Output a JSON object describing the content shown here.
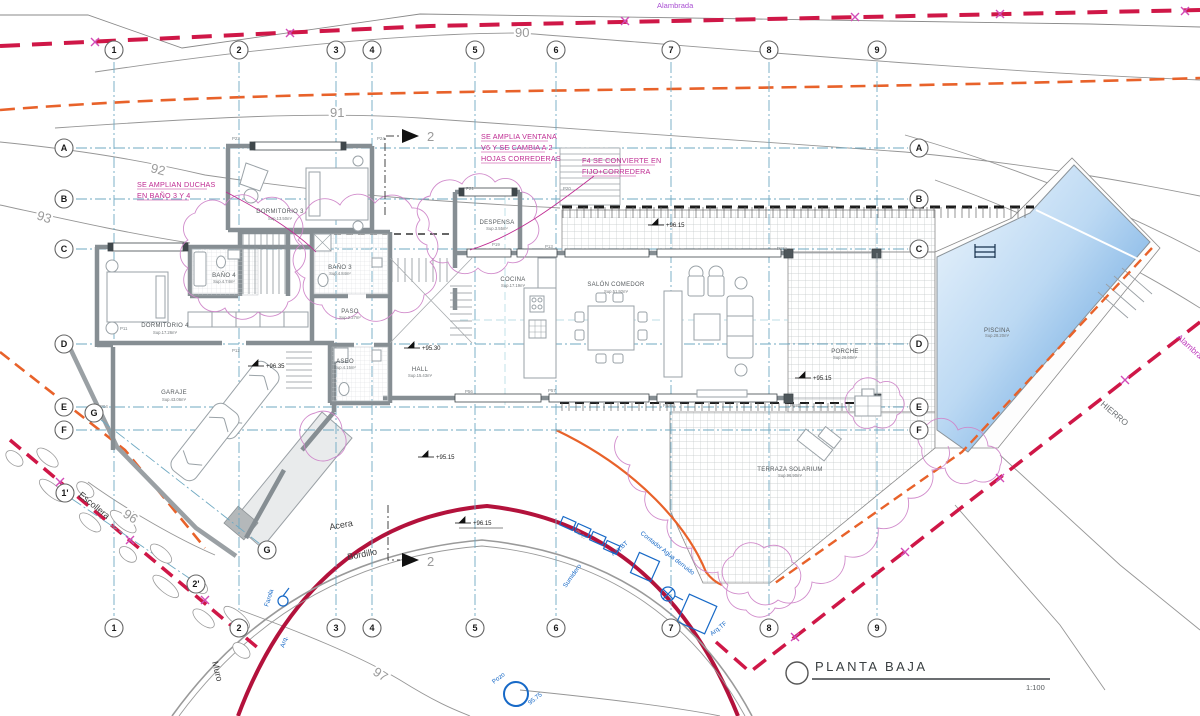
{
  "drawing_title": {
    "label": "PLANTA  BAJA",
    "scale": "1:100"
  },
  "grid_axes": {
    "columns": [
      "1",
      "2",
      "3",
      "4",
      "5",
      "6",
      "7",
      "8",
      "9"
    ],
    "rows": [
      "A",
      "B",
      "C",
      "D",
      "E",
      "F"
    ],
    "extra": {
      "g": "G",
      "prime1": "1'",
      "prime2": "2'"
    }
  },
  "rooms": {
    "dormitorio3": {
      "name": "DORMITORIO 3",
      "area": "Sup.13.50m²"
    },
    "dormitorio4": {
      "name": "DORMITORIO 4",
      "area": "Sup.17.26m²"
    },
    "bano3": {
      "name": "BAÑO 3",
      "area": "Sup.4.84m²"
    },
    "bano4": {
      "name": "BAÑO 4",
      "area": "Sup.4.74m²"
    },
    "paso": {
      "name": "PASO",
      "area": "Sup.2.27m²"
    },
    "aseo": {
      "name": "ASEO",
      "area": "Sup.4.15m²"
    },
    "hall": {
      "name": "HALL",
      "area": "Sup.15.43m²"
    },
    "garaje": {
      "name": "GARAJE",
      "area": "Sup.43.06m²"
    },
    "despensa": {
      "name": "DESPENSA",
      "area": "Sup.3.55m²"
    },
    "cocina": {
      "name": "COCINA",
      "area": "Sup.17.19m²"
    },
    "salon": {
      "name": "SALÓN COMEDOR",
      "area": "Sup.51.92m²"
    },
    "porche": {
      "name": "PORCHE",
      "area": "Sup.26.60m²"
    },
    "terraza": {
      "name": "TERRAZA SOLARIUM",
      "area": "Sup.96.90m²"
    },
    "piscina": {
      "name": "PISCINA",
      "area": "Sup.28.20m²"
    }
  },
  "revision_notes": {
    "window": [
      "SE AMPLIA VENTANA",
      "V6 Y SE CAMBIA A 2",
      "HOJAS CORREDERAS"
    ],
    "f4": [
      "F4 SE CONVIERTE EN",
      "FIJO+CORREDERA"
    ],
    "showers": [
      "SE AMPLIAN DUCHAS",
      "EN BAÑO 3 Y 4"
    ]
  },
  "levels": {
    "garage": "+96.35",
    "hall": "+95.30",
    "terrace": "+96.15",
    "porch": "+95.15",
    "exterior": "+95.15",
    "sidewalk": "+96.15"
  },
  "site_labels": {
    "acera": "Acera",
    "bordillo": "Bordillo",
    "muro": "Muro",
    "escollera": "Escollera",
    "alambrada_top": "Alambrada",
    "alambrada_right": "Alambrada",
    "hierro": "HIERRO"
  },
  "contour_labels": {
    "c90": "90",
    "c91": "91",
    "c92": "92",
    "c93": "93",
    "c96": "96",
    "c97": "97",
    "c9597": "95.97"
  },
  "utilities": {
    "sumidero": "Sumidero",
    "arq_bt": "Arq.BT",
    "arq_tf": "Arq.TF",
    "contador": "Contador Agua derruido",
    "farola": "Farola",
    "arq": "Arq.",
    "pozo": "Pozo",
    "pozo_level": "95.75"
  },
  "section_marks": {
    "label": "2"
  },
  "door_tags": [
    "P23",
    "P24",
    "P21",
    "P20",
    "P19",
    "P13",
    "P15a",
    "P11",
    "P12",
    "P04",
    "P56",
    "P57",
    "P58a",
    "P58b"
  ],
  "colors": {
    "boundary_red": "#cf1747",
    "street_wall_red": "#b3123c",
    "fence_x_magenta": "#d24bb8",
    "contour_orange": "#e8622a",
    "grid_blue": "#6fa9c2",
    "annotation_magenta": "#bf2b92",
    "cloud_pink": "#cf86c9",
    "utility_blue": "#1769c7",
    "pool_deep_blue": "#4e95d9",
    "wall_gray": "#868e93"
  }
}
